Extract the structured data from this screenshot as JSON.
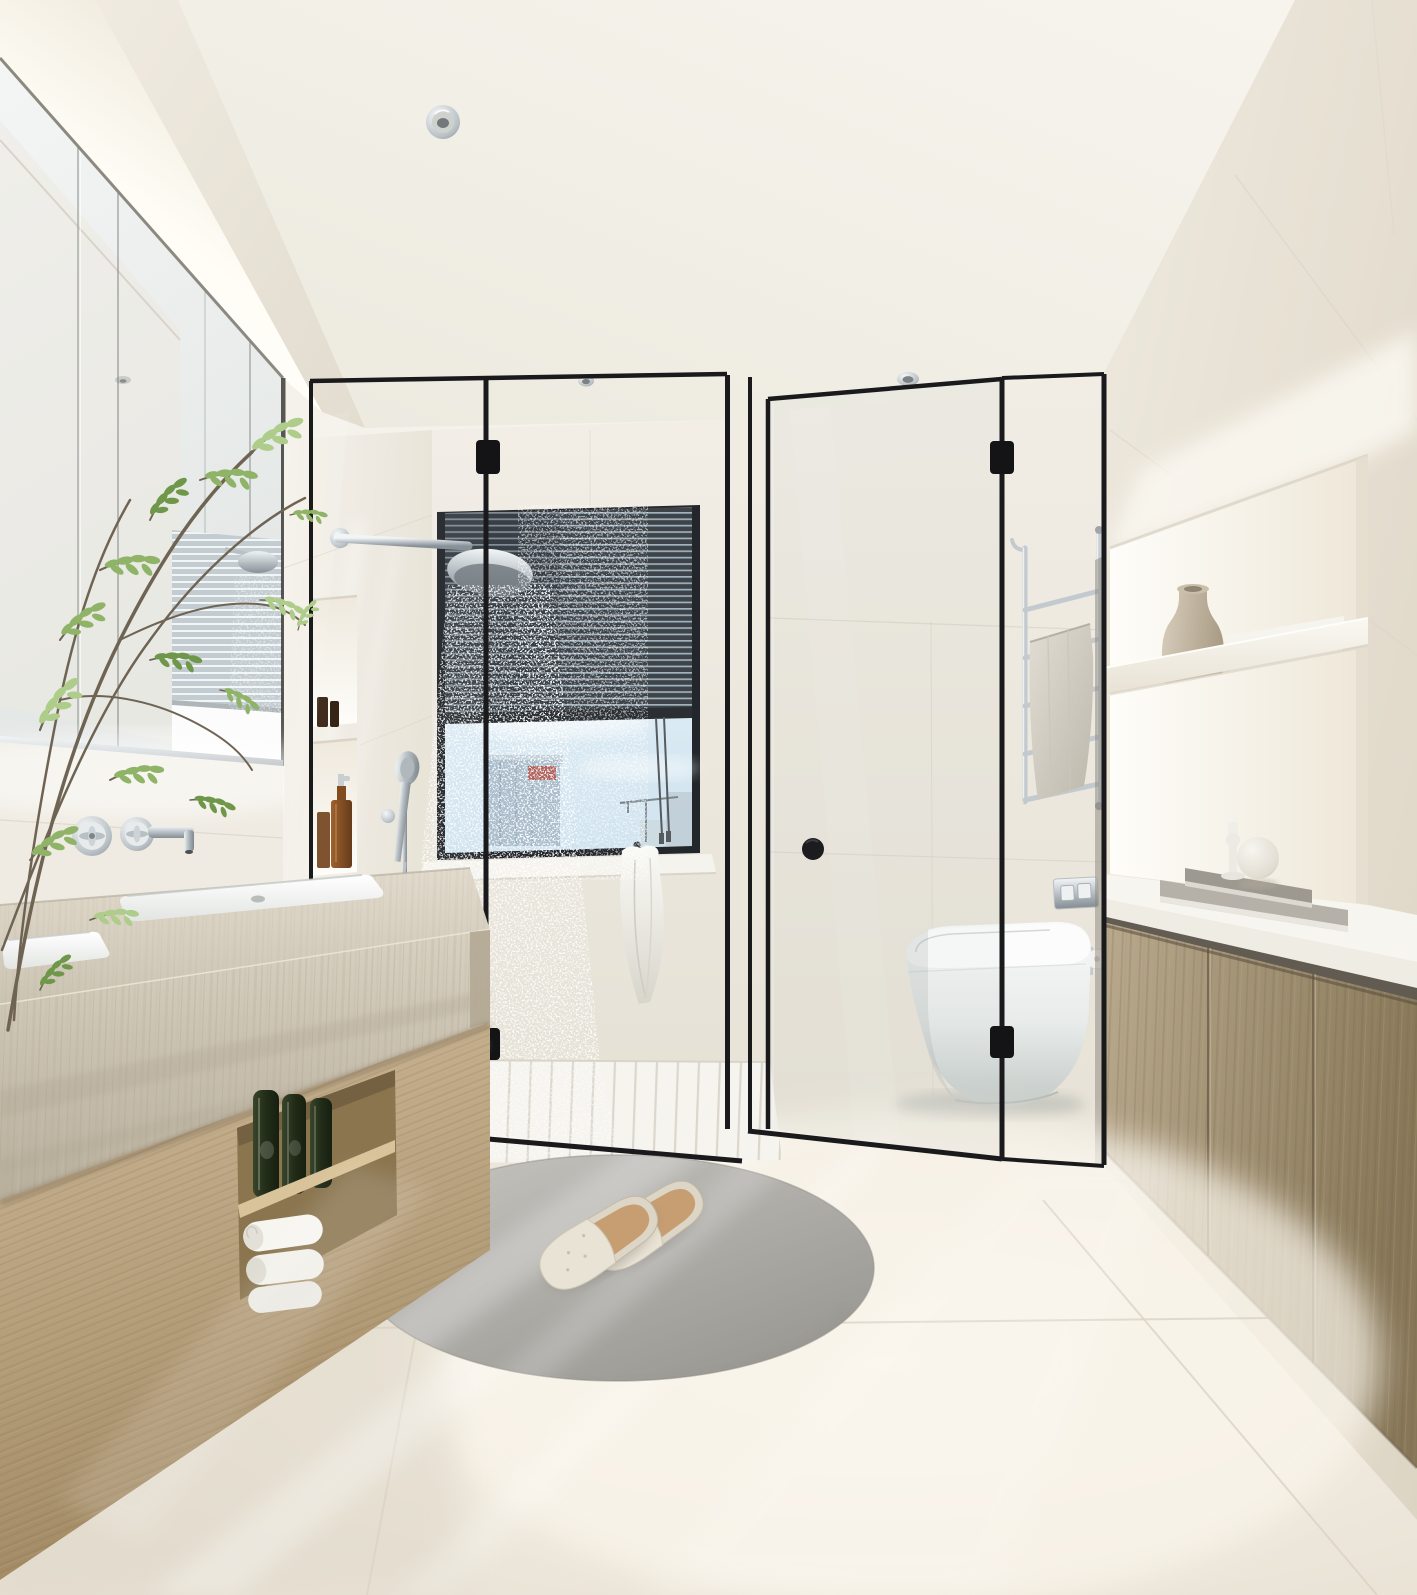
{
  "meta": {
    "kind": "interior-render",
    "room": "bathroom",
    "style": "minimal japandi, black-framed glass shower"
  },
  "palette": {
    "ceiling": "#f5f2eb",
    "soffit": "#ebe5da",
    "cove-glow": "#ffffff",
    "wall-warm": "#efebe2",
    "wall-shadow": "#ded8cb",
    "right-wall": "#eae4d8",
    "mirror": "#eef0ee",
    "frame-black": "#1a1a1d",
    "chrome": "#dfe4e6",
    "chrome-dark": "#8d969c",
    "travertine": "#cfc7b8",
    "travertine-dark": "#b4aa97",
    "wood": "#bfab8a",
    "wood-dark": "#9c8a6b",
    "wood-right": "#b0a084",
    "wood-right-dark": "#8c7c61",
    "floor": "#f1ece2",
    "floor-bright": "#f8f4eb",
    "grout": "#d9d2c4",
    "tray": "#f6f4ef",
    "tray-line": "#dbd7cd",
    "rug": "#b3b1ac",
    "rug-dark": "#9b9994",
    "sky": "#d8e8f2",
    "building": "#a9bcca",
    "building-red": "#b0544b",
    "blinds": "#3e4348",
    "blinds-gap": "#9fb2bd",
    "blinds-reflect": "#c3ccd1",
    "toilet": "#f6f7f6",
    "toilet-shadow": "#c7cdca",
    "towel-white": "#f4f2ec",
    "towel-gray": "#d5d0c5",
    "amber": "#8a4e1e",
    "bottle-green": "#2a351f",
    "vase": "#ccc2af",
    "leaf": "#8fb468",
    "leaf-light": "#aecd8a",
    "leaf-dark": "#6f9749",
    "branch": "#6f6454",
    "book": "#b5b1a8",
    "book-dark": "#9d9990"
  },
  "scene": {
    "objects": [
      {
        "name": "ceiling-downlight",
        "label": "recessed chrome downlight"
      },
      {
        "name": "led-cove",
        "label": "lit cove above mirror wall"
      },
      {
        "name": "mirror-cabinet",
        "label": "full-width mirror with reflected blinds and shower"
      },
      {
        "name": "plant",
        "label": "green leafy branches at left"
      },
      {
        "name": "wall-faucet",
        "label": "chrome wall-mounted basin mixer"
      },
      {
        "name": "vanity",
        "label": "travertine double-sink counter on oak cabinet"
      },
      {
        "name": "green-bottles",
        "label": "three dark green glass bottles on open shelf"
      },
      {
        "name": "rolled-towels",
        "label": "white rolled towels on open shelf"
      },
      {
        "name": "shower",
        "label": "black framed glass walk-in shower"
      },
      {
        "name": "window",
        "label": "city view window with half-closed venetian blinds"
      },
      {
        "name": "rain-shower",
        "label": "chrome rain head with water spray"
      },
      {
        "name": "hand-shower",
        "label": "chrome handheld shower on rail"
      },
      {
        "name": "hanging-towel",
        "label": "white towel on hook under window"
      },
      {
        "name": "toilet",
        "label": "white floor-standing toilet behind glass door"
      },
      {
        "name": "towel-ladder",
        "label": "chrome ladder rail with gray towel"
      },
      {
        "name": "niche-shelves",
        "label": "backlit wall niches with vase and folded towels"
      },
      {
        "name": "right-cabinet",
        "label": "wood sideboard with books and sphere decor"
      },
      {
        "name": "rug",
        "label": "oval gray rug"
      },
      {
        "name": "slippers",
        "label": "pair of cream slippers with cork soles"
      }
    ]
  }
}
